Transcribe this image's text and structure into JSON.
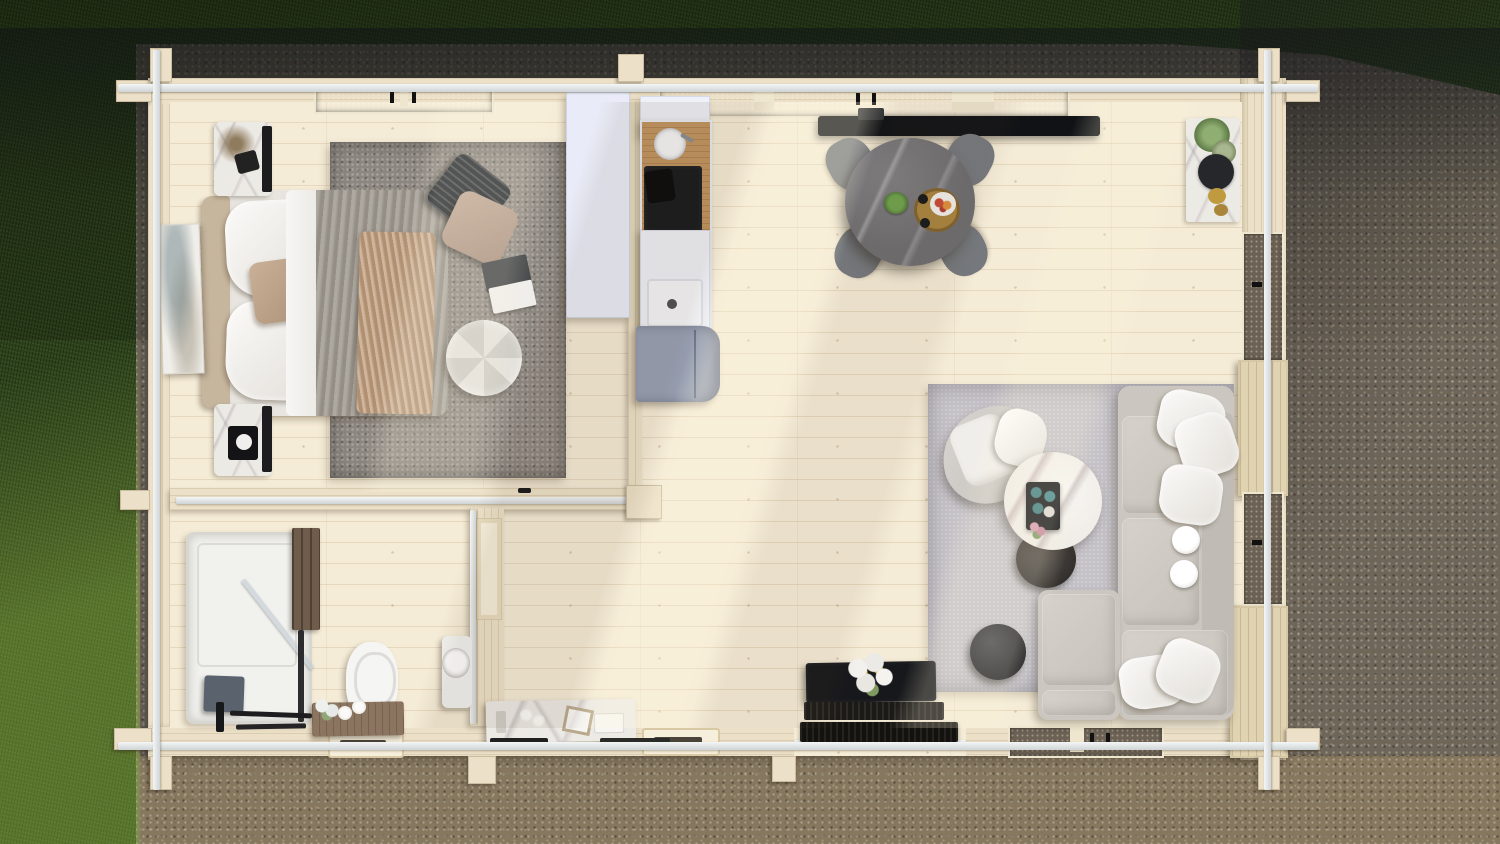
{
  "scene": {
    "description": "Top-down aerial 3D render of a one-bedroom log cabin interior floor plan",
    "environment": {
      "left_and_top": "green lawn grass, partly in tree shadow, sunlit patch at lower left",
      "surround": "grey-brown gravel apron on all other sides, dark shadow band along the top",
      "lighting": "warm sunlight entering from upper right with long diagonal tree shadows"
    }
  },
  "palette": {
    "grass-dark": "#2e431d",
    "grass-light": "#5f8633",
    "gravel-base": "#6e6659",
    "gravel-warm": "#86775f",
    "gravel-shadow": "#33363e",
    "wall": "#ece1c8",
    "wall-light": "#f6efdb",
    "beam-white": "#e9eced",
    "floor": "#f5ecd7",
    "glass-dark": "#3a3e44",
    "glass-warm": "#6b6154",
    "wood-door": "#e0d3b2",
    "rug-bedroom": "#8d8781",
    "rug-living": "#c4c1c7",
    "sofa": "#cbc7c0",
    "sofa-light": "#d6d2cb",
    "duvet-grey": "#a09a91",
    "blanket-tan": "#c3a283",
    "headboard-tan": "#c7b69e",
    "marble-white": "#efece6",
    "dining-table": "#6e6d70",
    "chair-grey": "#75797e",
    "wardrobe-white": "#e9ecf8",
    "fridge-grey": "#97a0b4",
    "counter-wood": "#c0935e",
    "cooktop-black": "#16181c",
    "console-black": "#17181b",
    "tv-black": "#101215",
    "accent-green": "#5c8c41",
    "flower-yellow": "#e4c93e",
    "bath-panel-wood": "#6f5c4a",
    "bath-grey": "#5a626d",
    "vanity-wood": "#8b7560"
  },
  "exterior": {
    "construction": "interlocking log walls, cream timber, silver-white cap beams crossing at every corner",
    "openings": [
      "bedroom double window in top wall",
      "long glazed section over kitchen and dining in top wall",
      "two glazed windows in right wall",
      "solid wood door panel in right wall",
      "open wooden door leaf at bottom-right corner",
      "glazed entrance section in bottom wall",
      "small ornate window in bathroom bottom wall",
      "small ornate window in hallway bottom wall",
      "entrance threshold with dark doormats in bottom wall"
    ]
  },
  "rooms": {
    "bedroom": {
      "label": "Bedroom",
      "furniture": [
        "double bed with white linen, grey duvet and wrinkled tan throw",
        "tan upholstered headboard against left wall",
        "two white-marble nightstands with black side panels and decor",
        "large mottled grey area rug",
        "round white tufted pouf",
        "black striped pillow and taupe pillow lying on rug",
        "open magazines on rug",
        "abstract artwork leaning on left wall",
        "dried branch decor on upper nightstand"
      ]
    },
    "kitchen": {
      "label": "Kitchen",
      "furniture": [
        "tall white wardrobe partition",
        "kitchen run with white cabinets and wood worktop",
        "round inset sink with faucet",
        "black induction cooktop with pan",
        "open white cabinet with basin",
        "blue-grey refrigerator unit"
      ]
    },
    "dining": {
      "label": "Dining area",
      "furniture": [
        "round dark marble dining table",
        "four grey upholstered chairs",
        "green plant and wooden serving tray with fruit bowl and cups",
        "wall-mounted black TV above table"
      ]
    },
    "living": {
      "label": "Living area",
      "furniture": [
        "light grey L-shaped sectional sofa along right wall",
        "chaise ottoman module",
        "five white scatter pillows and two round white trays on seats",
        "round white marble coffee table with black tray, teal cups and flowers",
        "dark round side table tucked under coffee table",
        "curved grey armchair with white throw",
        "black round pouf",
        "large light grey rug",
        "black console table with white lily bouquet near entrance",
        "two dark doormats at entrance threshold",
        "white sideboard with round black mirror tray, plants and gold bowls in top-right corner"
      ]
    },
    "bathroom": {
      "label": "Bathroom",
      "furniture": [
        "corner shower with white tray, glass door and dark wood feature panel",
        "dark grey wall radiator and black shower fittings",
        "white toilet",
        "wooden vanity shelf with flowers and spare rolls",
        "round white wash basin on pedestal against partition wall"
      ]
    },
    "hallway": {
      "label": "Hallway",
      "furniture": [
        "white marble console bench with frame, rolls and decor boxes",
        "dark runner mat",
        "paneled door to bathroom in partition wall",
        "door with black handle in bedroom partition wall"
      ]
    }
  }
}
